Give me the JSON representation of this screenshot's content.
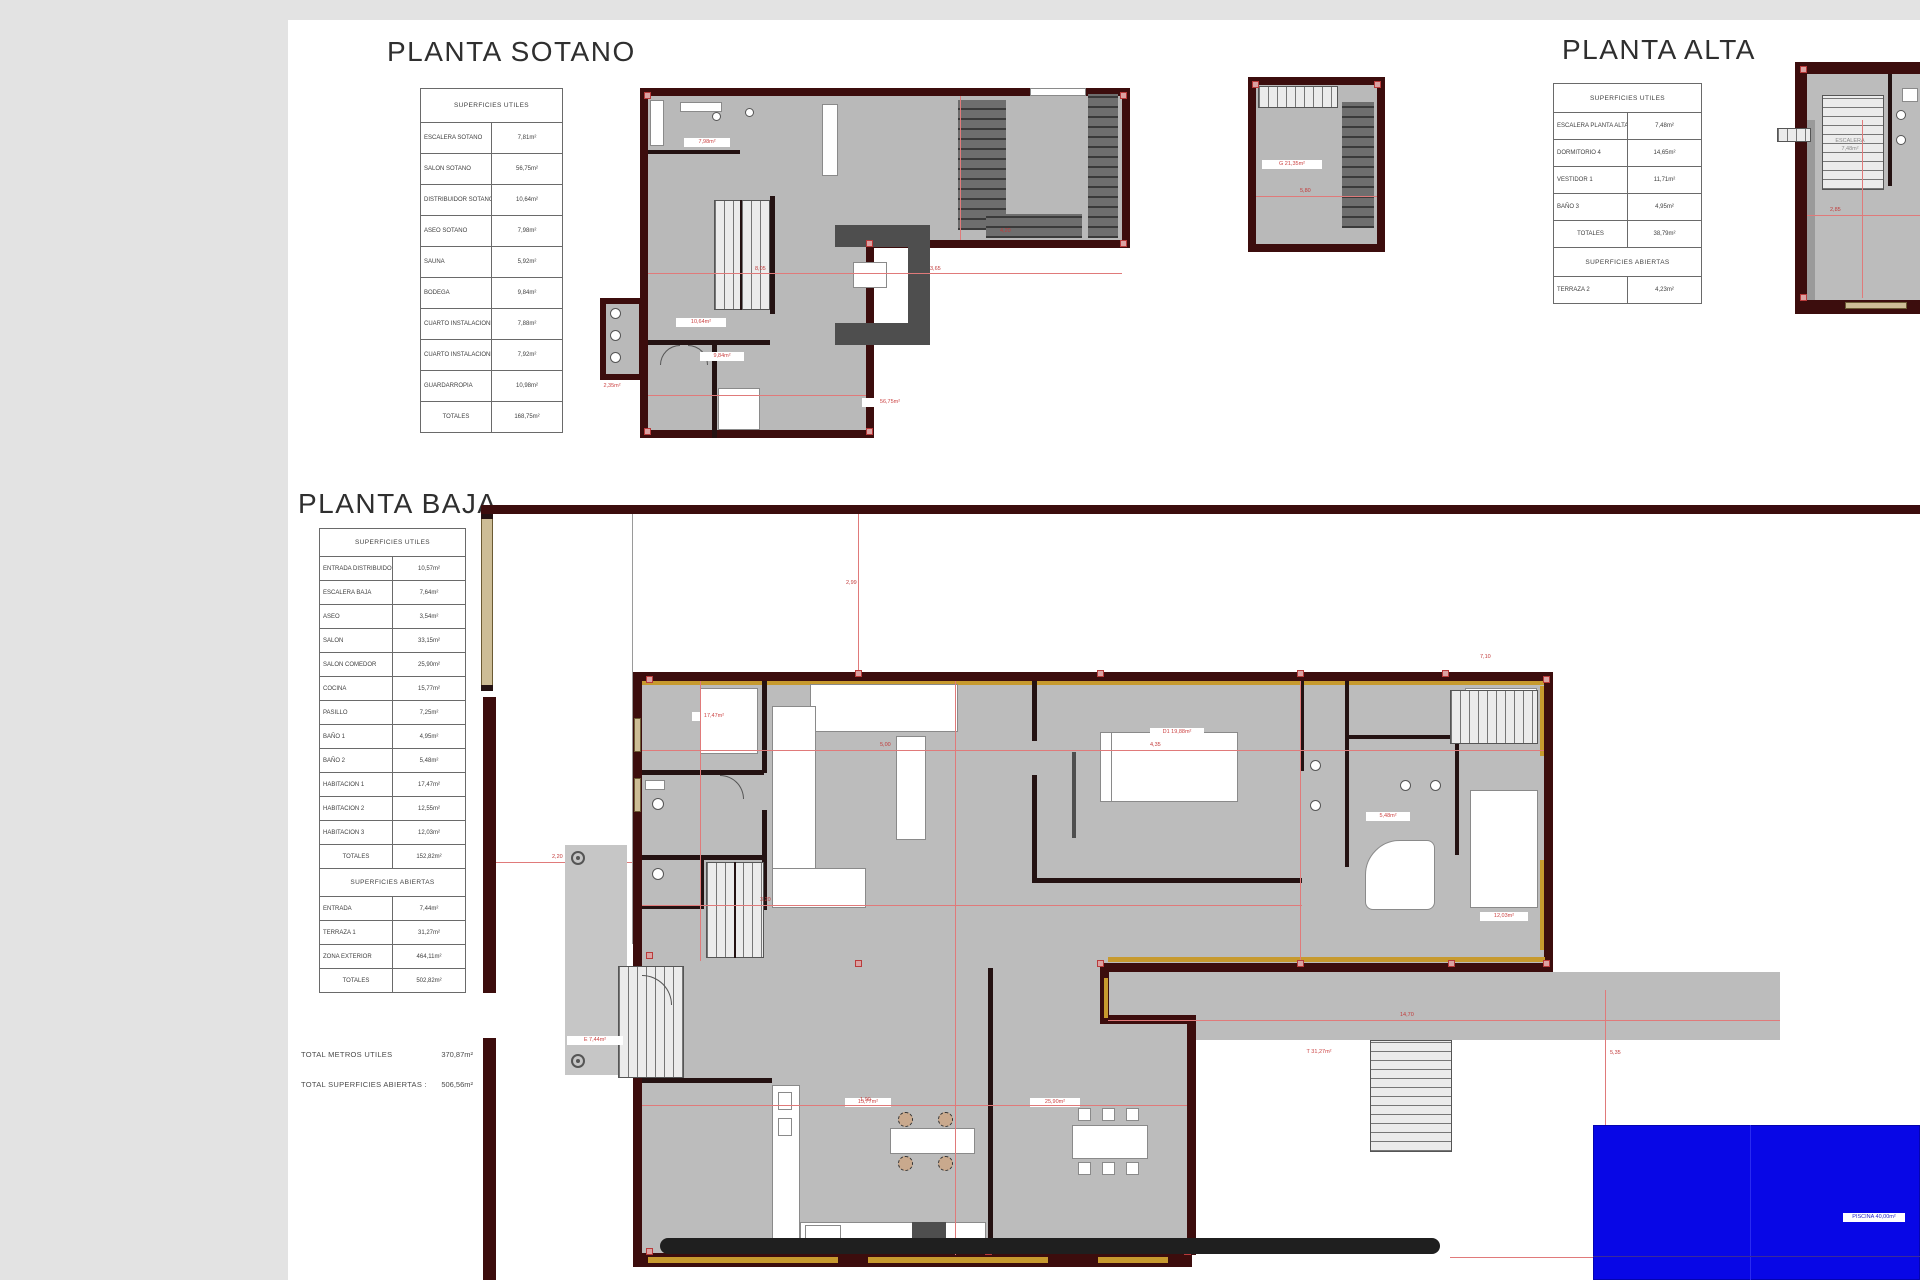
{
  "colors": {
    "canvas_background": "#e3e3e3",
    "paper": "#ffffff",
    "wall_maroon": "#3c0d0d",
    "wall_gold": "#c79a2e",
    "wall_tan": "#cdbd96",
    "floor_gray": "#bcbcbc",
    "dimension_red": "#cc4444",
    "pool_blue": "#0807e6"
  },
  "sotano": {
    "title": "PLANTA SOTANO",
    "table": {
      "header": "SUPERFICIES UTILES",
      "rows": [
        {
          "label": "ESCALERA SOTANO",
          "value": "7,81m²"
        },
        {
          "label": "SALON SOTANO",
          "value": "56,75m²"
        },
        {
          "label": "DISTRIBUIDOR SOTANO",
          "value": "10,64m²"
        },
        {
          "label": "ASEO SOTANO",
          "value": "7,98m²"
        },
        {
          "label": "SAUNA",
          "value": "5,92m²"
        },
        {
          "label": "BODEGA",
          "value": "9,84m²"
        },
        {
          "label": "CUARTO INSTALACIONES 1",
          "value": "7,88m²"
        },
        {
          "label": "CUARTO INSTALACIONES 2",
          "value": "7,92m²"
        },
        {
          "label": "GUARDARROPIA",
          "value": "10,98m²"
        }
      ],
      "total_label": "TOTALES",
      "total_value": "168,75m²"
    }
  },
  "alta": {
    "title": "PLANTA ALTA",
    "table": {
      "header": "SUPERFICIES UTILES",
      "rows": [
        {
          "label": "ESCALERA PLANTA ALTA",
          "value": "7,48m²"
        },
        {
          "label": "DORMITORIO 4",
          "value": "14,65m²"
        },
        {
          "label": "VESTIDOR 1",
          "value": "11,71m²"
        },
        {
          "label": "BAÑO 3",
          "value": "4,95m²"
        }
      ],
      "total_label": "TOTALES",
      "total_value": "38,79m²",
      "open_header": "SUPERFICIES ABIERTAS",
      "open_rows": [
        {
          "label": "TERRAZA 2",
          "value": "4,23m²"
        }
      ]
    }
  },
  "baja": {
    "title": "PLANTA BAJA",
    "table": {
      "header": "SUPERFICIES UTILES",
      "rows": [
        {
          "label": "ENTRADA DISTRIBUIDOR",
          "value": "10,57m²"
        },
        {
          "label": "ESCALERA BAJA",
          "value": "7,64m²"
        },
        {
          "label": "ASEO",
          "value": "3,54m²"
        },
        {
          "label": "SALON",
          "value": "33,15m²"
        },
        {
          "label": "SALON COMEDOR",
          "value": "25,90m²"
        },
        {
          "label": "COCINA",
          "value": "15,77m²"
        },
        {
          "label": "PASILLO",
          "value": "7,25m²"
        },
        {
          "label": "BAÑO 1",
          "value": "4,95m²"
        },
        {
          "label": "BAÑO 2",
          "value": "5,48m²"
        },
        {
          "label": "HABITACION 1",
          "value": "17,47m²"
        },
        {
          "label": "HABITACION 2",
          "value": "12,55m²"
        },
        {
          "label": "HABITACION 3",
          "value": "12,03m²"
        }
      ],
      "total_label": "TOTALES",
      "total_value": "152,82m²",
      "open_header": "SUPERFICIES ABIERTAS",
      "open_rows": [
        {
          "label": "ENTRADA",
          "value": "7,44m²"
        },
        {
          "label": "TERRAZA 1",
          "value": "31,27m²"
        },
        {
          "label": "ZONA EXTERIOR",
          "value": "464,11m²"
        }
      ],
      "open_total_label": "TOTALES",
      "open_total_value": "502,82m²"
    },
    "summary": [
      {
        "label": "TOTAL METROS UTILES",
        "value": "370,87m²"
      },
      {
        "label": "TOTAL SUPERFICIES ABIERTAS :",
        "value": "506,56m²"
      }
    ]
  },
  "pool": {
    "label": "PISCINA 40,00m²"
  },
  "plan_labels": {
    "sotano_bath": "7,98m²",
    "sotano_distribuidor": "10,64m²",
    "sotano_aseos": "2,35m²",
    "sotano_bodega": "9,84m²",
    "sotano_salon": "56,75m²",
    "block_garaje": "G 21,35m²",
    "alta_stairs_1": "ESCALERA",
    "alta_stairs_2": "7,48m²",
    "baja_dorm1": "17,47m²",
    "baja_master": "D1 19,88m²",
    "baja_cocina": "15,77m²",
    "baja_comedor": "25,90m²",
    "baja_terraza": "T 31,27m²",
    "baja_entrada": "E 7,44m²",
    "baja_bano2": "5,48m²",
    "baja_dorm3": "12,03m²"
  },
  "dims": [
    "5,00",
    "4,35",
    "3,20",
    "2,99",
    "8,05",
    "1,90",
    "6,45",
    "14,70",
    "3,65",
    "5,35",
    "2,20",
    "7,10",
    "4,20",
    "5,80",
    "2,85"
  ]
}
